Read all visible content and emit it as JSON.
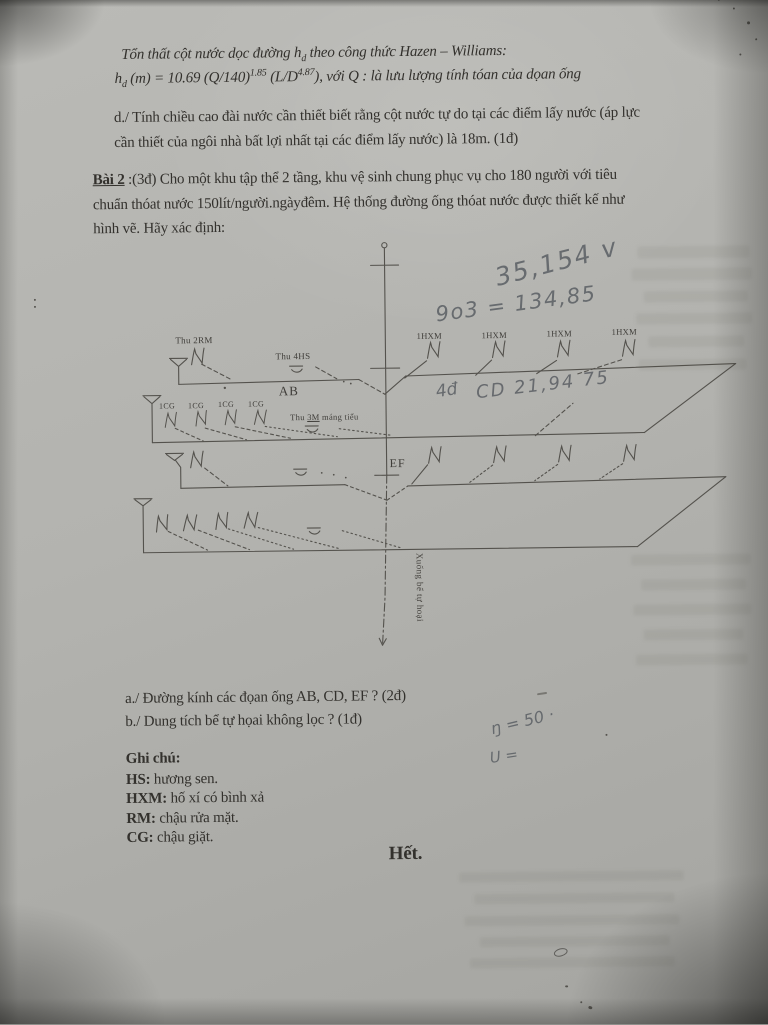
{
  "page": {
    "intro": {
      "line1_pre": "Tổn thất cột nước dọc đường h",
      "line1_sub": "d",
      "line1_post": " theo công thức Hazen – Williams:",
      "line2_var": "h",
      "line2_var_sub": "d",
      "line2_seg1": " (m) =  10.69 (Q/140)",
      "line2_sup1": "1.85",
      "line2_seg2": " (L/D",
      "line2_sup2": "4.87",
      "line2_seg3": "), với Q : là lưu lượng tính tóan của dọan ống"
    },
    "section_d": {
      "line1": "d./ Tính chiều cao đài nước cần thiết biết rằng cột nước tự do tại các điểm lấy nước (áp lực",
      "line2": "cần thiết của ngôi nhà bất lợi nhất tại các điểm lấy nước) là 18m. (1đ)"
    },
    "bai2": {
      "label": "Bài 2",
      "line1_rest": " :(3đ) Cho một khu tập thể 2 tầng, khu vệ sinh chung phục vụ cho 180 người với tiêu",
      "line2": "chuẩn thóat nước 150lít/người.ngàyđêm. Hệ thống đường ống thóat nước được thiết kế như",
      "line3": "hình vẽ. Hãy xác định:"
    },
    "diagram": {
      "thu_2rm": "Thu 2RM",
      "thu_4hs": "Thu 4HS",
      "ab": "AB",
      "hxm": "1HXM",
      "cg": "1CG",
      "thu_3m_pre": "Thu ",
      "thu_3m_mid": "3M",
      "thu_3m_post": " máng tiểu",
      "ef": "EF",
      "stack_note": "Xuống bể tự hoại"
    },
    "handwriting": {
      "note1": "35,154 v",
      "note2": "9o3 = 134,85",
      "note3": "4đ",
      "note4": "CD 21,94 75",
      "note5": "ŋ = 50 ·",
      "note6": "U ="
    },
    "questions": {
      "a": "a./ Đường kính các đọan ống AB, CD, EF ? (2đ)",
      "b": "b./ Dung tích bể tự họai không lọc ? (1đ)"
    },
    "legend": {
      "title": "Ghi chú:",
      "items": [
        {
          "key": "HS:",
          "text": " hương sen."
        },
        {
          "key": "HXM:",
          "text": " hố xí có bình xả"
        },
        {
          "key": "RM:",
          "text": " chậu rửa mặt."
        },
        {
          "key": "CG:",
          "text": " chậu giặt."
        }
      ]
    },
    "footer": "Hết."
  }
}
